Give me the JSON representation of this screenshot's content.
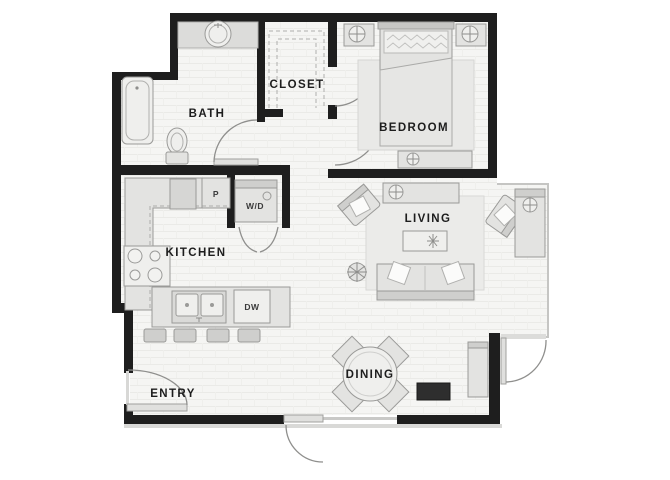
{
  "plan": {
    "rooms": {
      "bath": {
        "label": "BATH"
      },
      "closet": {
        "label": "CLOSET"
      },
      "bedroom": {
        "label": "BEDROOM"
      },
      "kitchen": {
        "label": "KITCHEN"
      },
      "living": {
        "label": "LIVING"
      },
      "dining": {
        "label": "DINING"
      },
      "entry": {
        "label": "ENTRY"
      }
    },
    "fixtures": {
      "pantry_label": "P",
      "washer_dryer_label": "W/D",
      "dishwasher_label": "DW"
    },
    "colors": {
      "wall": "#1e1e1e",
      "floor": "#f5f5f3",
      "floor_line": "#eaeae7",
      "furniture_fill": "#e3e3e1",
      "furniture_stroke": "#9a9a98",
      "door_arc": "#8f8f8d",
      "dark_accent": "#2e2e2e"
    }
  }
}
